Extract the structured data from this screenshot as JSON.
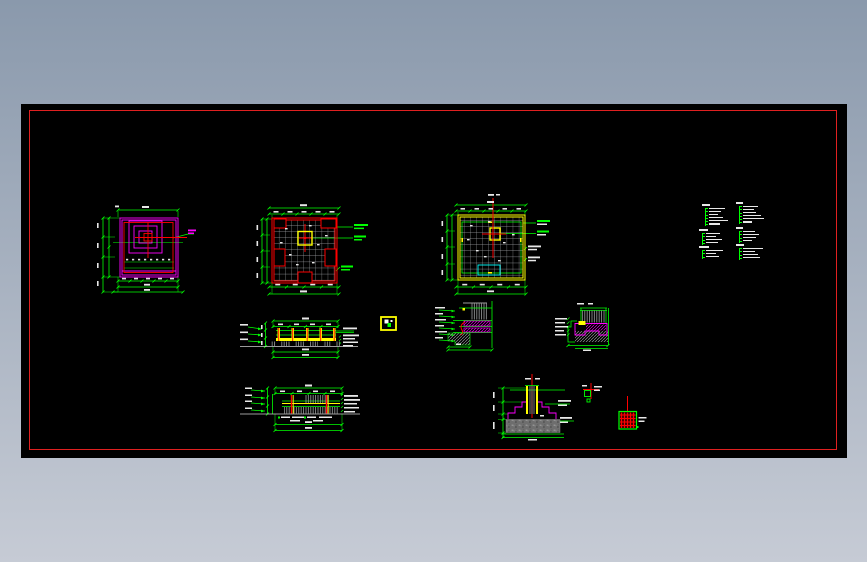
{
  "meta": {
    "app_label": "cad-drawing-viewer",
    "description": "Black CAD model space with red sheet border showing foundation plan details, wall/footing section details and specification note blocks; no readable text at screen resolution"
  },
  "colors": {
    "background_top": "#8a99ac",
    "background_bottom": "#c6cbd5",
    "canvas": "#000000",
    "frame_red": "#e02020",
    "line_green": "#00ff00",
    "line_magenta": "#ff00ff",
    "line_red": "#ff0000",
    "line_yellow": "#ffff00",
    "line_cyan": "#00ffff",
    "grid_gray": "#a9acaf",
    "hatch_gray": "#8e9092",
    "text_white": "#e8e8e8"
  },
  "drawings": {
    "plan1": {
      "label": "foundation plan detail with concentric magenta squares"
    },
    "plan2": {
      "label": "foundation plan detail with red border and gray grid"
    },
    "plan3": {
      "label": "foundation plan detail with yellow border and gray grid"
    },
    "sectionA": {
      "label": "long footing section upper"
    },
    "sectionB": {
      "label": "long footing section lower"
    },
    "detailC": {
      "label": "wall base section detail"
    },
    "detailD": {
      "label": "footing edge section detail"
    },
    "detailE": {
      "label": "column footing section detail"
    },
    "detailF": {
      "label": "small anchor detail"
    },
    "detailG": {
      "label": "rebar mesh square detail"
    },
    "symbolH": {
      "label": "column legend symbol"
    }
  },
  "notes": {
    "label": "specification note blocks (illegible micro text)",
    "blocks": [
      {
        "x": 702,
        "y": 204,
        "title_w": 8,
        "lines": [
          16,
          12,
          9,
          14,
          19,
          11
        ]
      },
      {
        "x": 736,
        "y": 202,
        "title_w": 7,
        "lines": [
          15,
          11,
          13,
          18,
          21,
          9
        ]
      },
      {
        "x": 699,
        "y": 229,
        "title_w": 9,
        "lines": [
          14,
          10,
          16,
          12
        ]
      },
      {
        "x": 736,
        "y": 227,
        "title_w": 7,
        "lines": [
          12,
          16,
          13,
          9
        ]
      },
      {
        "x": 699,
        "y": 246,
        "title_w": 10,
        "lines": [
          17,
          10,
          13
        ]
      },
      {
        "x": 736,
        "y": 244,
        "title_w": 8,
        "lines": [
          20,
          12,
          15,
          17
        ]
      }
    ]
  }
}
